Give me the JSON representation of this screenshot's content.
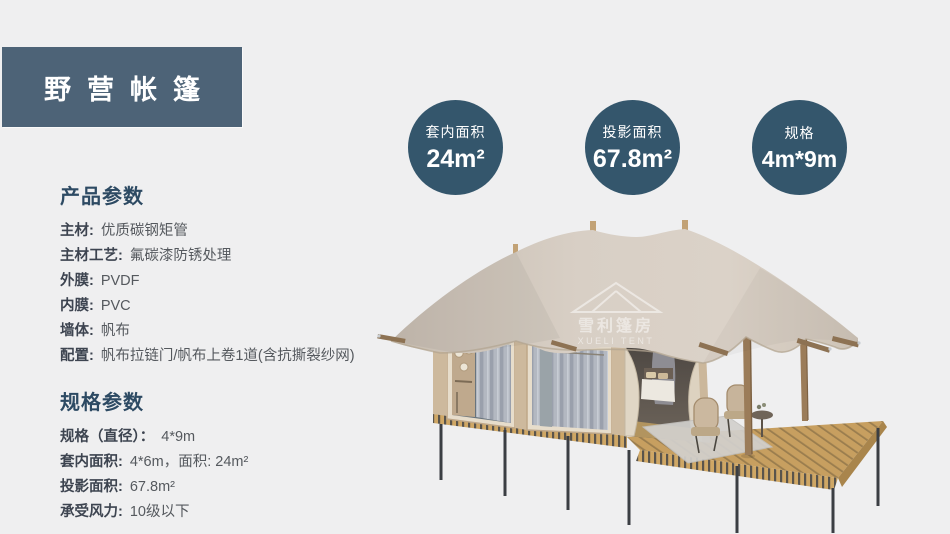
{
  "header": {
    "title": "野营帐篷"
  },
  "stat_circles": [
    {
      "label": "套内面积",
      "value": "24m²"
    },
    {
      "label": "投影面积",
      "value": "67.8m²"
    },
    {
      "label": "规格",
      "value": "4m*9m"
    }
  ],
  "product_params": {
    "heading": "产品参数",
    "items": [
      {
        "label": "主材:",
        "value": "优质碳钢矩管"
      },
      {
        "label": "主材工艺:",
        "value": "氟碳漆防锈处理"
      },
      {
        "label": "外膜:",
        "value": "PVDF"
      },
      {
        "label": "内膜:",
        "value": "PVC"
      },
      {
        "label": "墙体:",
        "value": "帆布"
      },
      {
        "label": "配置:",
        "value": "帆布拉链门/帆布上卷1道(含抗撕裂纱网)"
      }
    ]
  },
  "spec_params": {
    "heading": "规格参数",
    "items": [
      {
        "label": "规格（直径）：",
        "value": "4*9m"
      },
      {
        "label": "套内面积:",
        "value": "4*6m，面积: 24m²"
      },
      {
        "label": "投影面积:",
        "value": "67.8m²"
      },
      {
        "label": "承受风力:",
        "value": "10级以下"
      }
    ]
  },
  "tent": {
    "watermark_cn": "雪利篷房",
    "watermark_en": "XUELI TENT"
  },
  "colors": {
    "page_bg": "#efeff0",
    "title_box_bg": "#4d6377",
    "circle_bg": "#34566c",
    "heading_text": "#2d4a63",
    "label_text": "#3d4450",
    "value_text": "#55595e",
    "roof_canvas": "#d8cfc5",
    "cabin_wall": "#ddcfba",
    "deck_wood": "#c79f60",
    "metal_leg": "#3b3e43"
  }
}
